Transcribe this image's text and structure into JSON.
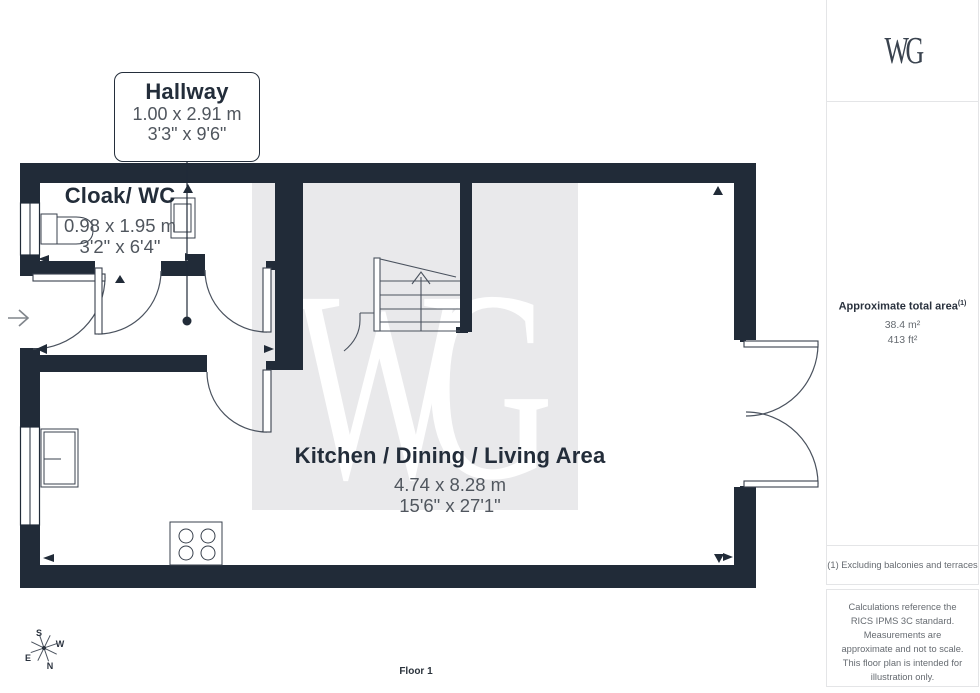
{
  "plan": {
    "rooms": {
      "hallway": {
        "name": "Hallway",
        "metric": "1.00 x 2.91 m",
        "imperial": "3'3\" x 9'6\""
      },
      "cloak_wc": {
        "name": "Cloak/ WC",
        "metric": "0.98 x 1.95 m",
        "imperial": "3'2\" x 6'4\""
      },
      "kitchen_dining_living": {
        "name": "Kitchen / Dining / Living Area",
        "metric": "4.74 x 8.28 m",
        "imperial": "15'6\" x 27'1\""
      }
    },
    "floor_label": "Floor 1",
    "watermark_text": "WG",
    "compass": {
      "n": "N",
      "s": "S",
      "e": "E",
      "w": "W"
    }
  },
  "sidebar": {
    "logo_text": "WG",
    "area": {
      "label": "Approximate total area",
      "footnote_marker": "(1)",
      "metric": "38.4 m²",
      "imperial": "413 ft²"
    },
    "footnote": "(1) Excluding balconies and terraces",
    "disclaimer": "Calculations reference the RICS IPMS 3C standard. Measurements are approximate and not to scale. This floor plan is intended for illustration only.",
    "brand": {
      "name": "GIRAFFE",
      "suffix": "360"
    }
  },
  "colors": {
    "wall": "#212B38",
    "title_text": "#232D3A",
    "dim_text": "#50565E",
    "muted_text": "#666B71",
    "watermark_bg": "#E9E9EB",
    "watermark_fg": "#FFFFFF",
    "line": "#4A525E"
  }
}
